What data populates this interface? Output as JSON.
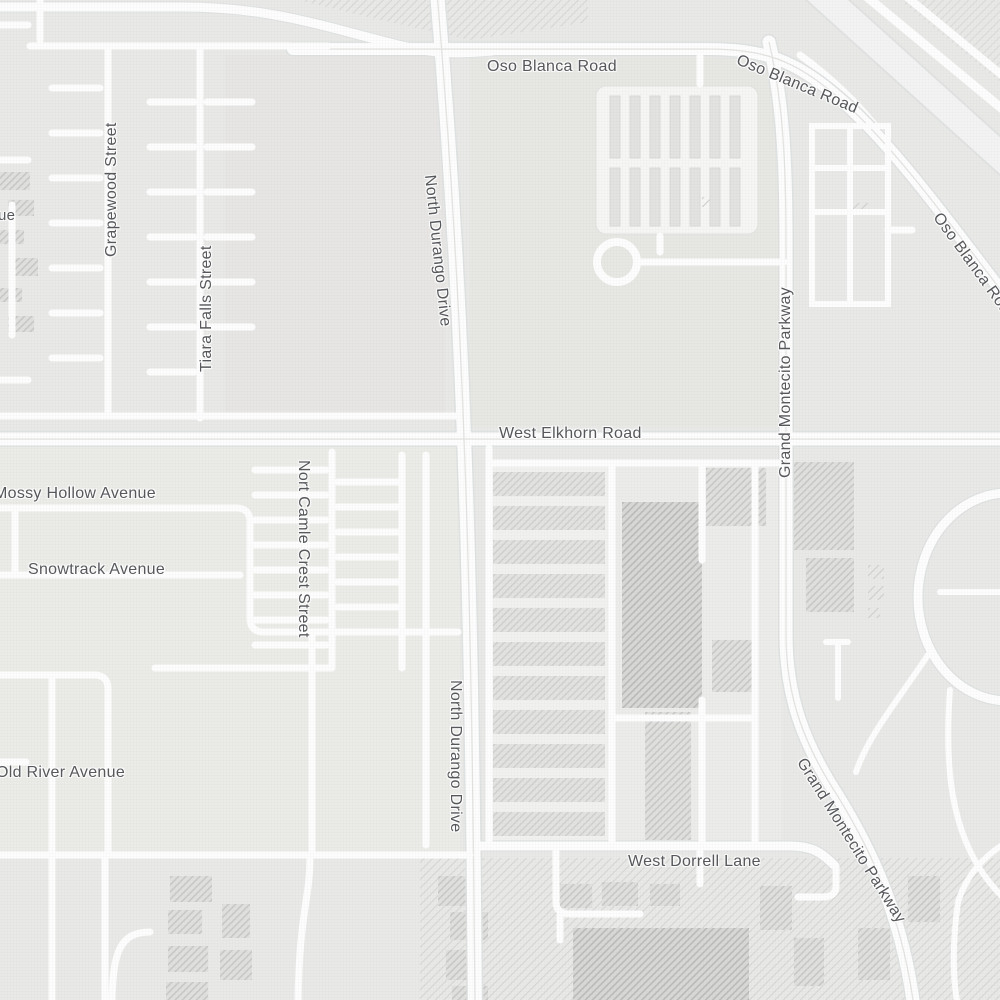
{
  "map_type": "street-map",
  "palette": {
    "background": "#e9e9e7",
    "road": "#fdfdfd",
    "road_casing": "#dfe2e2",
    "highway": "#f2f3f2",
    "label": "#55575b",
    "hatch": "#c6c6c4",
    "building": "#e0e0de",
    "building_dark": "#d8d8d6"
  },
  "labels": {
    "oso_blanca_road_a": "Oso Blanca Road",
    "oso_blanca_road_b": "Oso Blanca Road",
    "oso_blanca_road_c": "Oso Blanca Road",
    "north_durango_drive_a": "North Durango Drive",
    "north_durango_drive_b": "North Durango Drive",
    "west_elkhorn_road": "West Elkhorn Road",
    "grand_montecito_parkway_a": "Grand Montecito Parkway",
    "grand_montecito_parkway_b": "Grand Montecito Parkway",
    "grapewood_street": "Grapewood Street",
    "tiara_falls_street": "Tiara Falls Street",
    "nort_camle_crest_street": "Nort Camle Crest Street",
    "mossy_hollow_avenue": "Mossy Hollow Avenue",
    "snowtrack_avenue": "Snowtrack Avenue",
    "old_river_avenue": "Old River Avenue",
    "west_dorrell_lane": "West Dorrell Lane",
    "partial_avenue": "ue"
  }
}
